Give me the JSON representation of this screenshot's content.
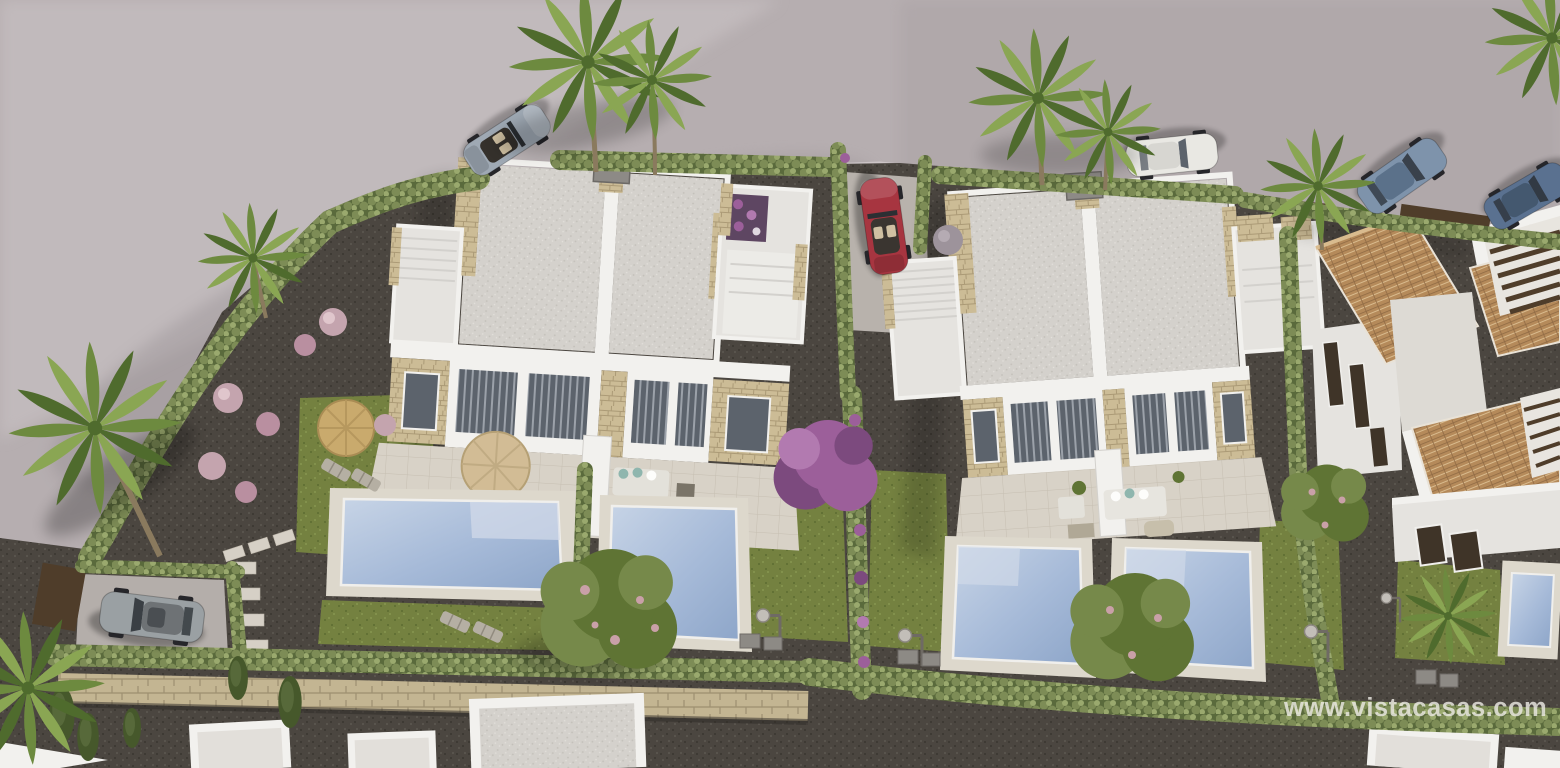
{
  "image": {
    "type": "3d-architectural-render",
    "subject": "Aerial view of new-build modern villas with private pools, gardens and street parking",
    "width": 1560,
    "height": 768
  },
  "watermark": {
    "text": "www.vistacasas.com"
  },
  "colors": {
    "road": "#b6aeb0",
    "roadLight": "#cbc4c6",
    "roadShadow": "#8f888c",
    "curb": "#cfc8ca",
    "gravelDark": "#4b4640",
    "gravelDot": "#5a554e",
    "grass": "#748140",
    "grassDark": "#5c6c31",
    "grassLight": "#879650",
    "hedge": "#7d8c56",
    "hedgeDark": "#5a6a3c",
    "hedgeLight": "#9aa96e",
    "white": "#f2f1ee",
    "whiteShade": "#e5e3df",
    "whiteDark": "#d3d1cd",
    "stone": "#ccbc96",
    "stoneDark": "#ab9a76",
    "roofGravel": "#d4d1cc",
    "roofDot": "#c3c0ba",
    "pave": "#d8d2c7",
    "paveLine": "#c6bfb2",
    "poolWater": "#a6bad8",
    "poolDeep": "#8ea6c9",
    "poolLight": "#c7d4e6",
    "poolDeck": "#ddd8cc",
    "stoneWall": "#c3b592",
    "stoneWallLine": "#9d8f70",
    "terracotta": "#b58a5a",
    "terracottaDark": "#8f6a44",
    "terracottaLight": "#d9bb8e",
    "wood": "#4f3d2a",
    "glass": "#5c636c",
    "blind": "#9ba1a9",
    "carSilver": "#9fa9b4",
    "carWhite": "#e9e8e3",
    "carBlue": "#7e93ab",
    "carNavy": "#5a7190",
    "carRed": "#a73540",
    "carGrey": "#9aa0a3",
    "seatTan": "#cfc0a2",
    "palm1": "#6d8a3f",
    "palm2": "#4f6b2d",
    "palm3": "#8aa653",
    "treeGreen": "#5f7434",
    "treeGreen2": "#76894a",
    "treePink": "#c9a0a8",
    "purple": "#9c5f9a",
    "purpleDark": "#7c4a7e",
    "trunk": "#8a7a5e",
    "flowerPink": "#c4a4ae",
    "watermark": "#eceae4"
  },
  "scene": {
    "buildings": [
      {
        "label": "modern duplex villa left",
        "roof": "flat gravel roof with white parapet and stone accents"
      },
      {
        "label": "modern duplex villa right",
        "roof": "flat gravel roof with white parapet and stone accents"
      },
      {
        "label": "mediterranean house right",
        "roof": "terracotta tiles with pergolas"
      },
      {
        "label": "neighbouring villa bottom right",
        "roof": "flat white"
      }
    ],
    "pools": 5,
    "cars": [
      {
        "label": "silver convertible",
        "location": "street top left"
      },
      {
        "label": "white car",
        "location": "street top centre"
      },
      {
        "label": "blue suv",
        "location": "street top right"
      },
      {
        "label": "dark blue suv",
        "location": "street far right"
      },
      {
        "label": "red convertible",
        "location": "driveway between villas"
      },
      {
        "label": "grey suv",
        "location": "driveway bottom left"
      }
    ],
    "vegetation": [
      "palm trees",
      "clipped cypress hedges",
      "bougainvillea",
      "lawns",
      "pink flower bushes"
    ]
  }
}
